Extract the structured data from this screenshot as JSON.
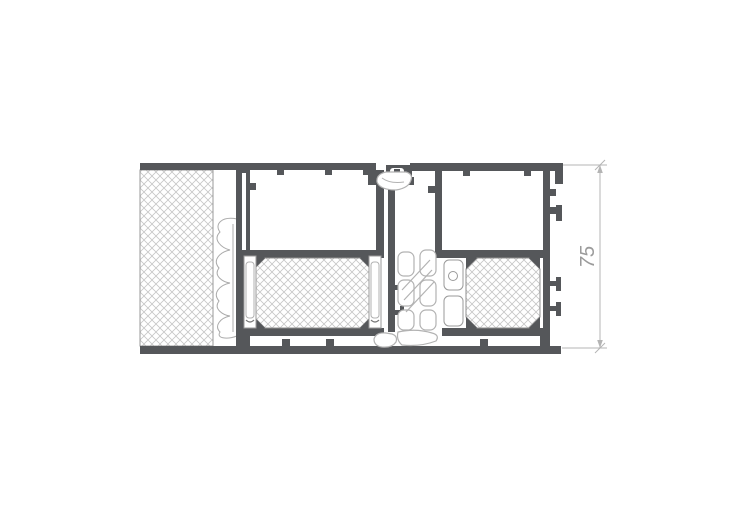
{
  "drawing": {
    "type": "aluminium-frame-cross-section",
    "dimension": {
      "label": "75"
    },
    "colors": {
      "background": "#ffffff",
      "profile_dark": "#55575a",
      "hatch_line": "#c6c6c6",
      "block_outline": "#8f8f8f",
      "gasket_line": "#b2b2b2",
      "slot_line": "#9a9a9a",
      "foam_line": "#ababab",
      "dimension_line": "#b4b4b4",
      "dimension_text": "#9b9b9b"
    },
    "components": [
      "wall-insulation-hatch",
      "foam-sealing-tape",
      "outer-frame-profile",
      "sash-frame-profile",
      "thermal-break-left",
      "thermal-break-right",
      "center-gasket",
      "top-gasket",
      "glazing-chamber",
      "dimension-annotation"
    ]
  }
}
